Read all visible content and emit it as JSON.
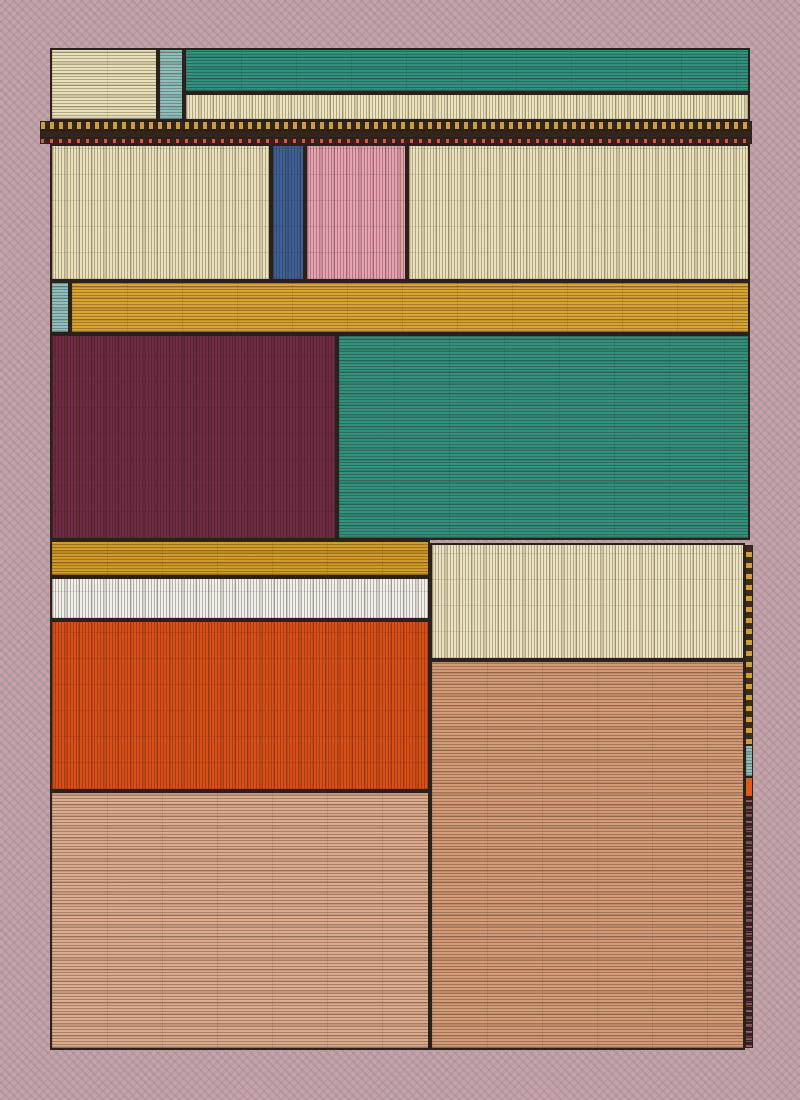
{
  "artwork": {
    "title": "woven-patchwork-composition",
    "canvas": {
      "width": 800,
      "height": 1100
    },
    "ink_color": "#2b211b",
    "background": {
      "base": "#c9a1a6"
    },
    "palette": {
      "cream": "#eae1bb",
      "teal_light": "#8fbfbc",
      "teal_green": "#31917f",
      "gold": "#d8a432",
      "maroon": "#6e2b43",
      "blue": "#3d6099",
      "pink": "#e8a1b1",
      "white": "#f2f0ea",
      "orange": "#d94f17",
      "salmon_light": "#dcab8e",
      "salmon_dark": "#d59b77",
      "dark_brown": "#33261a"
    },
    "blocks": [
      {
        "name": "top-left-cream-block",
        "x": 50,
        "y": 48,
        "w": 108,
        "h": 73,
        "color": "#e9e0ba",
        "tex": "h",
        "thin": false
      },
      {
        "name": "top-teal-strip",
        "x": 158,
        "y": 48,
        "w": 26,
        "h": 73,
        "color": "#8fbfbc",
        "tex": "h",
        "thin": false
      },
      {
        "name": "top-teal-band",
        "x": 184,
        "y": 48,
        "w": 566,
        "h": 45,
        "color": "#2f9180",
        "tex": "h",
        "thin": false
      },
      {
        "name": "top-cream-fringe-band",
        "x": 184,
        "y": 93,
        "w": 566,
        "h": 28,
        "color": "#ece3bd",
        "tex": "v",
        "thin": false
      },
      {
        "name": "divider-gold-dash-band",
        "x": 40,
        "y": 121,
        "w": 712,
        "h": 9,
        "color": "#33261a",
        "tex": "dash-gold-h",
        "thin": true
      },
      {
        "name": "divider-dark-band",
        "x": 40,
        "y": 130,
        "w": 712,
        "h": 8,
        "color": "#33251b",
        "tex": "plain",
        "thin": true
      },
      {
        "name": "divider-red-dash-band",
        "x": 40,
        "y": 138,
        "w": 712,
        "h": 6,
        "color": "#3a201c",
        "tex": "dash-red-h",
        "thin": true
      },
      {
        "name": "second-row-cream-left",
        "x": 50,
        "y": 144,
        "w": 221,
        "h": 137,
        "color": "#eae1bb",
        "tex": "v",
        "thin": false
      },
      {
        "name": "second-row-blue-block",
        "x": 271,
        "y": 144,
        "w": 34,
        "h": 137,
        "color": "#3d6099",
        "tex": "v",
        "thin": false
      },
      {
        "name": "second-row-pink-block",
        "x": 305,
        "y": 144,
        "w": 102,
        "h": 137,
        "color": "#e8a1b1",
        "tex": "v",
        "thin": false
      },
      {
        "name": "second-row-cream-right",
        "x": 407,
        "y": 144,
        "w": 343,
        "h": 137,
        "color": "#eae1bb",
        "tex": "v",
        "thin": false
      },
      {
        "name": "gold-band-teal-cap",
        "x": 50,
        "y": 281,
        "w": 20,
        "h": 53,
        "color": "#8fbfbc",
        "tex": "h",
        "thin": false
      },
      {
        "name": "upper-gold-band",
        "x": 70,
        "y": 281,
        "w": 680,
        "h": 53,
        "color": "#d8a432",
        "tex": "h",
        "thin": false
      },
      {
        "name": "maroon-block",
        "x": 50,
        "y": 334,
        "w": 287,
        "h": 206,
        "color": "#6e2b43",
        "tex": "v",
        "thin": false
      },
      {
        "name": "large-teal-block",
        "x": 337,
        "y": 334,
        "w": 413,
        "h": 206,
        "color": "#32907e",
        "tex": "h",
        "thin": false
      },
      {
        "name": "lower-gold-band",
        "x": 50,
        "y": 540,
        "w": 380,
        "h": 37,
        "color": "#d09b28",
        "tex": "h",
        "thin": false
      },
      {
        "name": "white-fringe-band",
        "x": 50,
        "y": 577,
        "w": 380,
        "h": 43,
        "color": "#f2f0ea",
        "tex": "v",
        "thin": false
      },
      {
        "name": "orange-block",
        "x": 50,
        "y": 620,
        "w": 380,
        "h": 171,
        "color": "#d94f17",
        "tex": "v",
        "thin": false
      },
      {
        "name": "salmon-block-left",
        "x": 50,
        "y": 791,
        "w": 380,
        "h": 259,
        "color": "#dcab8e",
        "tex": "h",
        "thin": false
      },
      {
        "name": "lower-right-cream-block",
        "x": 430,
        "y": 543,
        "w": 315,
        "h": 117,
        "color": "#ece3c0",
        "tex": "v",
        "thin": false
      },
      {
        "name": "salmon-block-right",
        "x": 430,
        "y": 660,
        "w": 315,
        "h": 390,
        "color": "#d59b77",
        "tex": "h",
        "thin": false
      },
      {
        "name": "edge-strip-gold-dash",
        "x": 745,
        "y": 545,
        "w": 8,
        "h": 200,
        "color": "#3a2c1c",
        "tex": "dash-gold-v",
        "thin": true
      },
      {
        "name": "edge-strip-teal",
        "x": 745,
        "y": 745,
        "w": 8,
        "h": 32,
        "color": "#8fbfb6",
        "tex": "h",
        "thin": true
      },
      {
        "name": "edge-strip-orange",
        "x": 745,
        "y": 777,
        "w": 8,
        "h": 20,
        "color": "#dd5a1c",
        "tex": "plain",
        "thin": true
      },
      {
        "name": "edge-strip-dark",
        "x": 745,
        "y": 797,
        "w": 8,
        "h": 251,
        "color": "#35212a",
        "tex": "speckle-v",
        "thin": true
      }
    ]
  }
}
